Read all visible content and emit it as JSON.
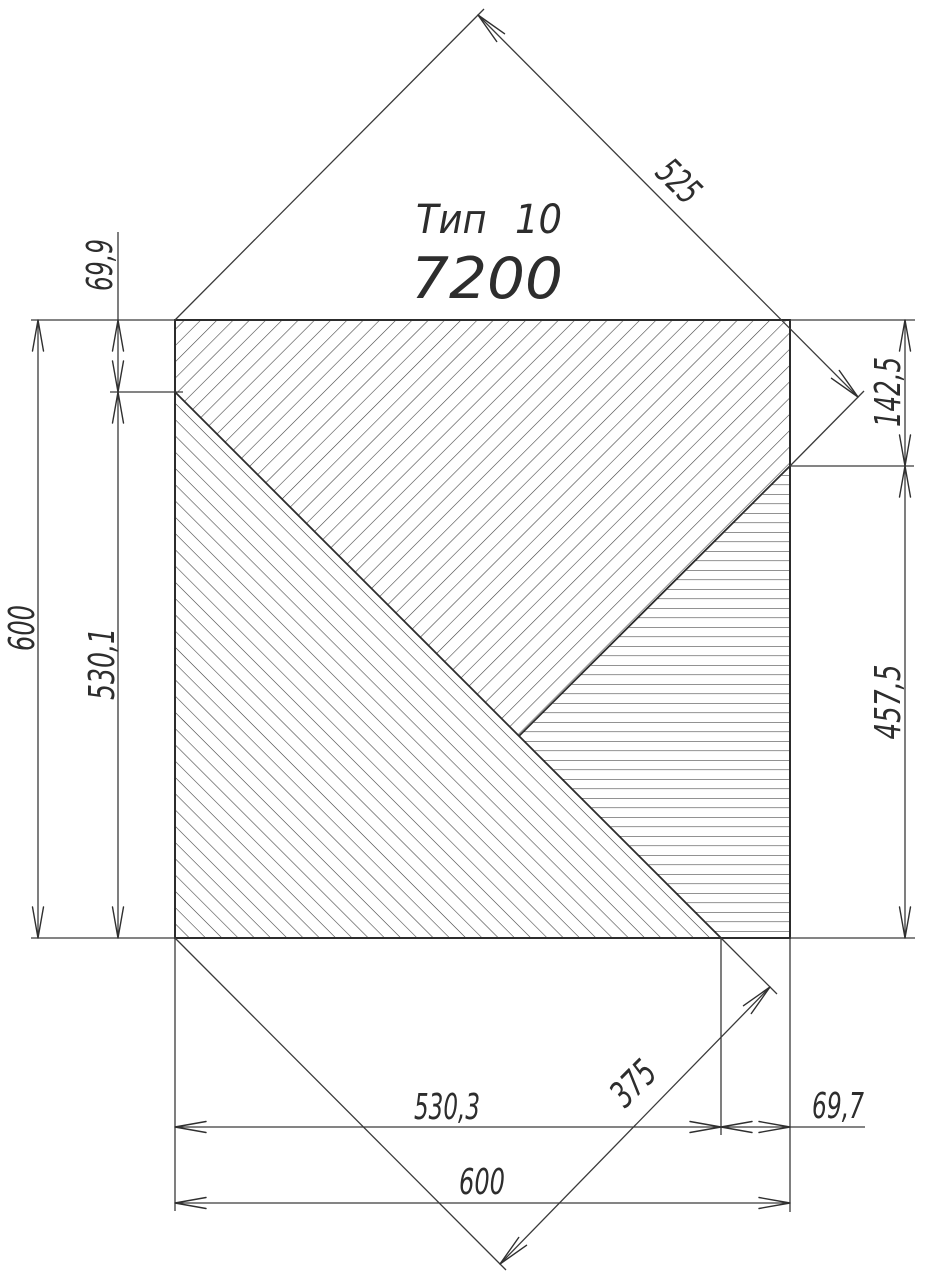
{
  "title": {
    "line1": "Тип 10",
    "line2": "7200"
  },
  "dimensions": {
    "left_total": "600",
    "left_upper": "69,9",
    "left_lower": "530,1",
    "right_upper": "142,5",
    "right_lower": "457,5",
    "top_diagonal": "525",
    "bottom_diagonal": "375",
    "bottom_left": "530,3",
    "bottom_right": "69,7",
    "bottom_total": "600"
  },
  "figure": {
    "type_label": "Тип 10",
    "code": "7200",
    "square_size_units": [
      600,
      600
    ],
    "left_edge_segments_units": {
      "upper": 69.9,
      "lower": 530.1,
      "total": 600
    },
    "right_edge_segments_units": {
      "upper": 142.5,
      "lower": 457.5
    },
    "bottom_edge_segments_units": {
      "left": 530.3,
      "right": 69.7,
      "total": 600
    },
    "diagonal_band_widths_units": {
      "top_band": 525,
      "bottom_band": 375
    },
    "regions": [
      {
        "name": "top-band",
        "hatch": "diagonal-up (/)",
        "vertices_units": [
          [
            0,
            0
          ],
          [
            600,
            0
          ],
          [
            600,
            142.5
          ],
          [
            334,
            403
          ],
          [
            0,
            69.9
          ]
        ]
      },
      {
        "name": "bottom-left-triangle",
        "hatch": "diagonal-down (\\)",
        "vertices_units": [
          [
            0,
            69.9
          ],
          [
            530.3,
            600
          ],
          [
            0,
            600
          ]
        ]
      },
      {
        "name": "right-band",
        "hatch": "horizontal (-)",
        "vertices_units": [
          [
            600,
            142.5
          ],
          [
            600,
            600
          ],
          [
            530.3,
            600
          ],
          [
            334,
            403
          ]
        ]
      }
    ]
  },
  "colors": {
    "background": "#ffffff",
    "line": "#2c2c2c",
    "hatch": "#404040",
    "text": "#2d2d2d"
  }
}
